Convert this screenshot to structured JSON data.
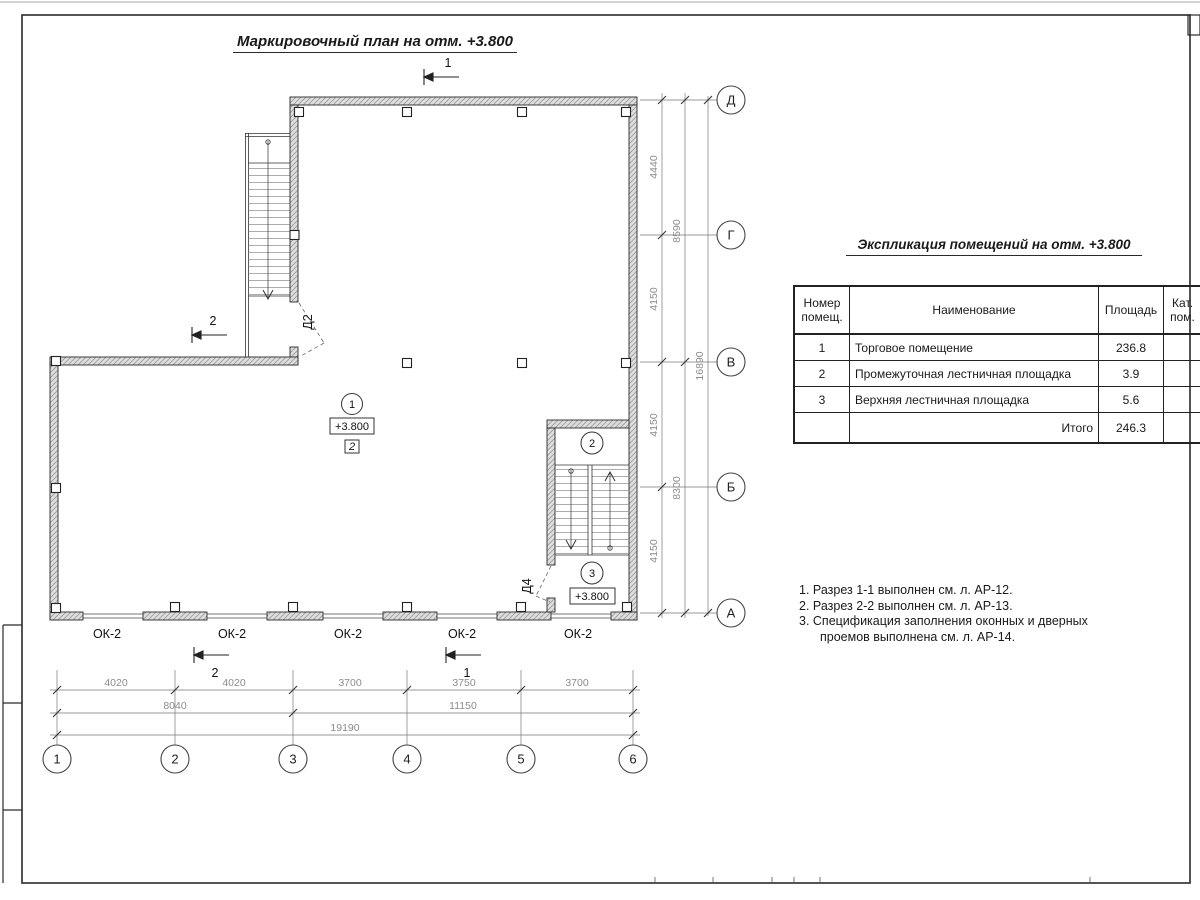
{
  "sheet": {
    "plan_title": "Маркировочный план на отм. +3.800",
    "schedule_title": "Экспликация помещений на отм. +3.800"
  },
  "schedule": {
    "headers": {
      "number": "Номер помещ.",
      "name": "Наименование",
      "area": "Площадь",
      "category": "Кат. пом."
    },
    "rows": [
      {
        "number": "1",
        "name": "Торговое помещение",
        "area": "236.8",
        "category": ""
      },
      {
        "number": "2",
        "name": "Промежуточная лестничная площадка",
        "area": "3.9",
        "category": ""
      },
      {
        "number": "3",
        "name": "Верхняя лестничная площадка",
        "area": "5.6",
        "category": ""
      }
    ],
    "total_label": "Итого",
    "total_value": "246.3"
  },
  "notes": {
    "line1": "1. Разрез 1-1 выполнен см. л. АР-12.",
    "line2": "2. Разрез 2-2 выполнен см. л. АР-13.",
    "line3": "3. Спецификация заполнения оконных и дверных",
    "line4": "проемов выполнена см. л. АР-14."
  },
  "axes": {
    "h": [
      "1",
      "2",
      "3",
      "4",
      "5",
      "6"
    ],
    "v": [
      "Д",
      "Г",
      "В",
      "Б",
      "А"
    ]
  },
  "dims": {
    "right": {
      "c1": [
        "4440",
        "4150",
        "4150",
        "4150"
      ],
      "c2": [
        "8590",
        "8300"
      ],
      "total": "16890"
    },
    "bottom": {
      "c1": [
        "4020",
        "4020",
        "3700",
        "3750",
        "3700"
      ],
      "c2": [
        "8040",
        "11150"
      ],
      "total": "19190"
    }
  },
  "plan": {
    "windows": [
      "ОК-2",
      "ОК-2",
      "ОК-2",
      "ОК-2",
      "ОК-2"
    ],
    "doors": {
      "d2": "Д2",
      "d4": "Д4"
    },
    "rooms": {
      "r1": {
        "tag": "1",
        "elevation": "+3.800",
        "category": "2"
      },
      "r2": {
        "tag": "2"
      },
      "r3": {
        "tag": "3",
        "elevation": "+3.800"
      }
    },
    "sections": {
      "s1": "1",
      "s2": "2"
    }
  }
}
